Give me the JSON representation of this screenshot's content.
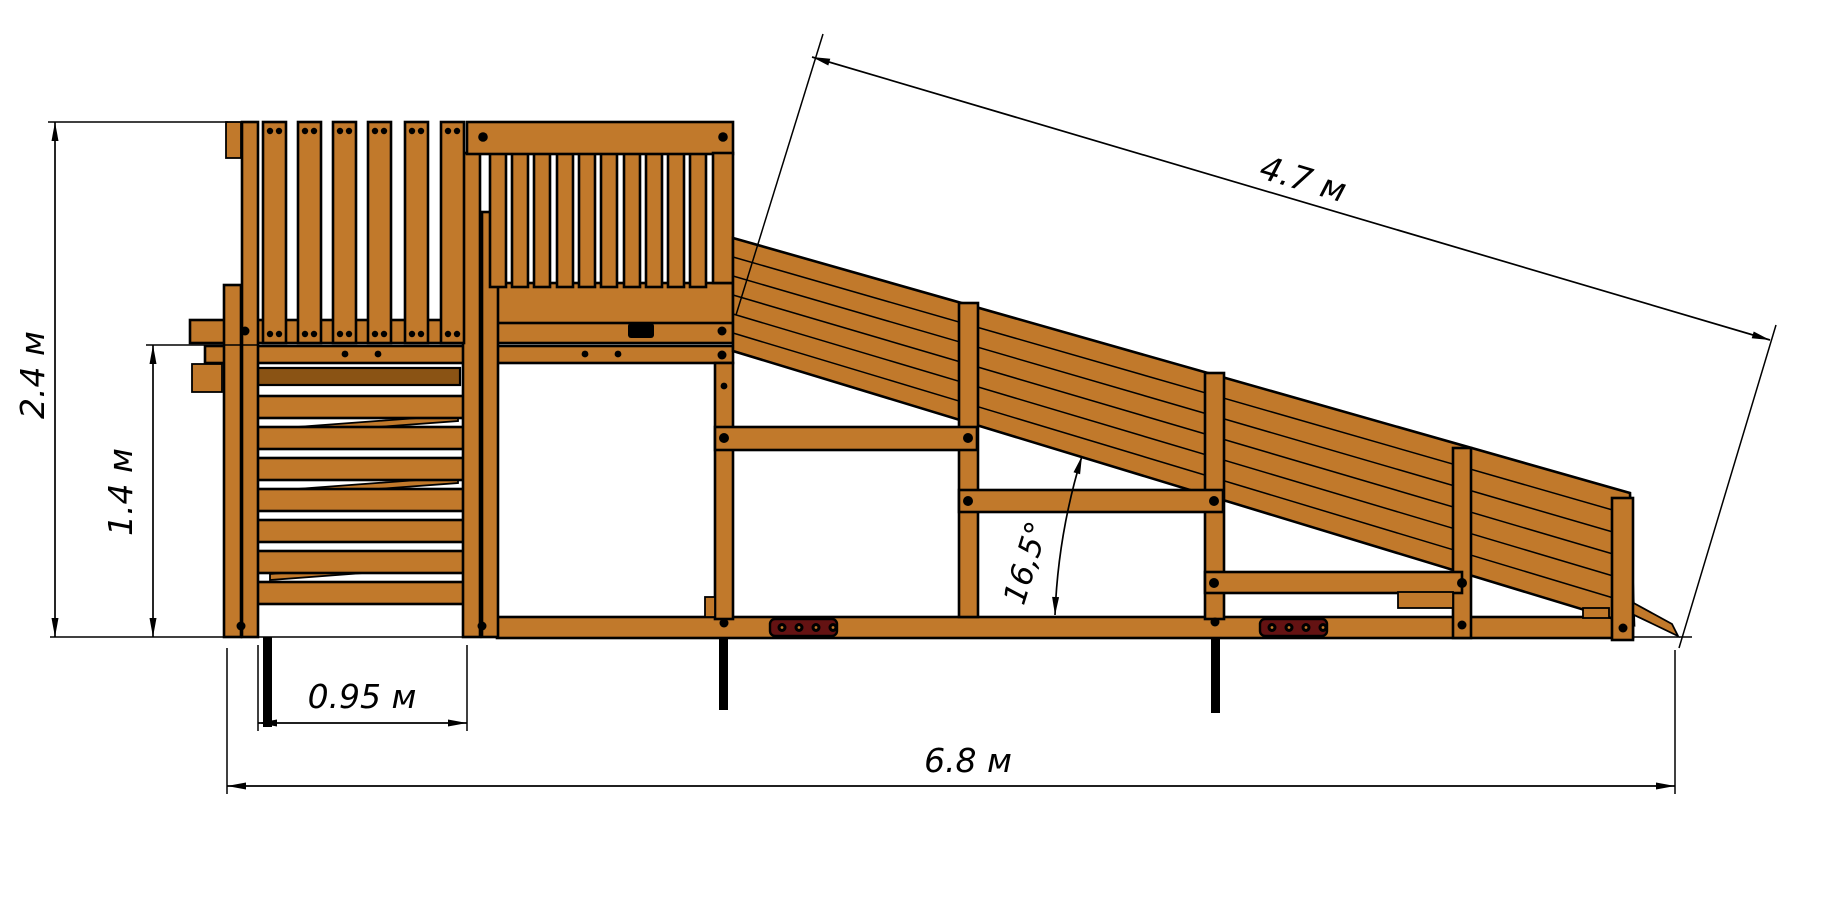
{
  "drawing": {
    "type": "technical-side-view",
    "subject": "wooden playground slide structure",
    "units": "м",
    "colors": {
      "wood": "#c1792b",
      "wood_dark": "#8a5314",
      "mount_plate": "#641212",
      "lines": "#000000",
      "background": "#ffffff"
    },
    "dimensions": {
      "total_height": {
        "label": "2.4 м",
        "orientation": "vertical"
      },
      "platform_height": {
        "label": "1.4 м",
        "orientation": "vertical"
      },
      "ladder_width": {
        "label": "0.95 м",
        "orientation": "horizontal"
      },
      "total_length": {
        "label": "6.8 м",
        "orientation": "horizontal"
      },
      "slide_length": {
        "label": "4.7 м",
        "orientation": "aligned"
      },
      "slide_angle": {
        "label": "16,5°",
        "orientation": "angular"
      }
    }
  }
}
